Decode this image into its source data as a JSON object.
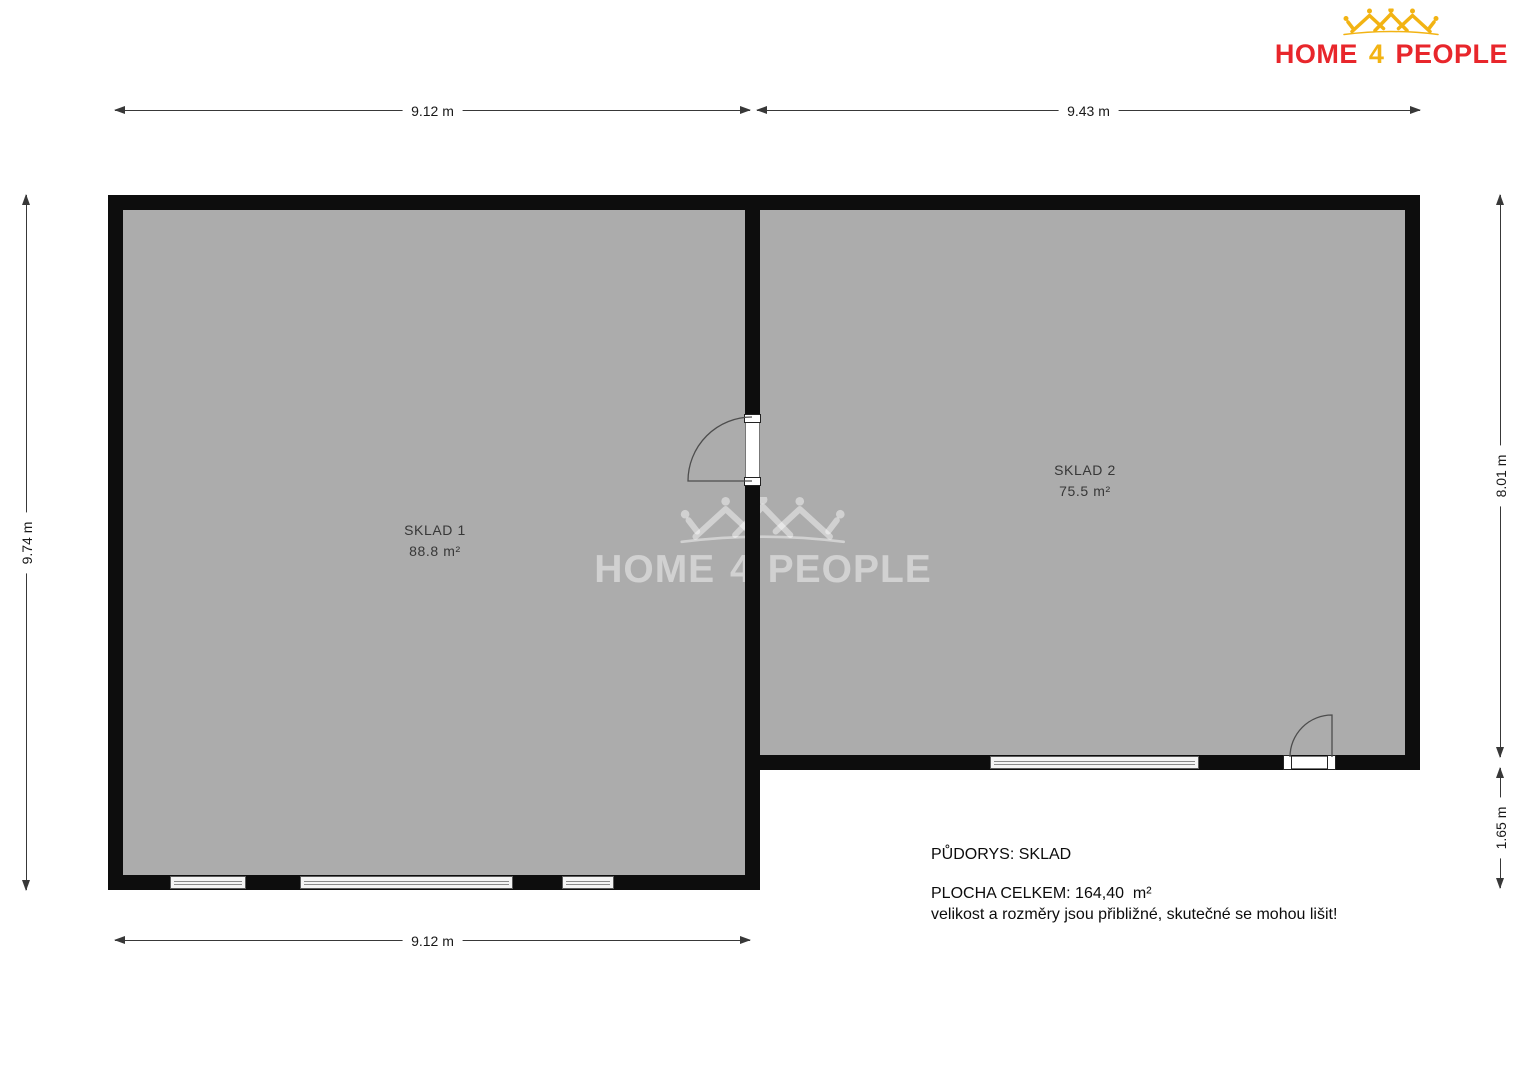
{
  "logo": {
    "home": "HOME",
    "four": "4",
    "people": "PEOPLE"
  },
  "watermark": {
    "home": "HOME",
    "four": "4",
    "people": "PEOPLE"
  },
  "plan": {
    "title": "PŮDORYS: SKLAD",
    "rooms": [
      {
        "name": "SKLAD 1",
        "area": "88.8 m²"
      },
      {
        "name": "SKLAD 2",
        "area": "75.5 m²"
      }
    ],
    "dimensions": {
      "top_left": "9.12 m",
      "top_right": "9.43 m",
      "left": "9.74 m",
      "right_upper": "8.01 m",
      "right_lower": "1.65 m",
      "bottom": "9.12 m"
    }
  },
  "notes": {
    "title": "PŮDORYS: SKLAD",
    "total": "PLOCHA CELKEM: 164,40  m²",
    "disclaimer": "velikost a rozměry jsou přibližné, skutečné se mohou lišit!"
  },
  "colors": {
    "room_fill": "#acacac",
    "wall": "#0d0d0d",
    "dimension_line": "#383838",
    "logo_red": "#e8262b",
    "logo_yellow": "#f2b313"
  }
}
